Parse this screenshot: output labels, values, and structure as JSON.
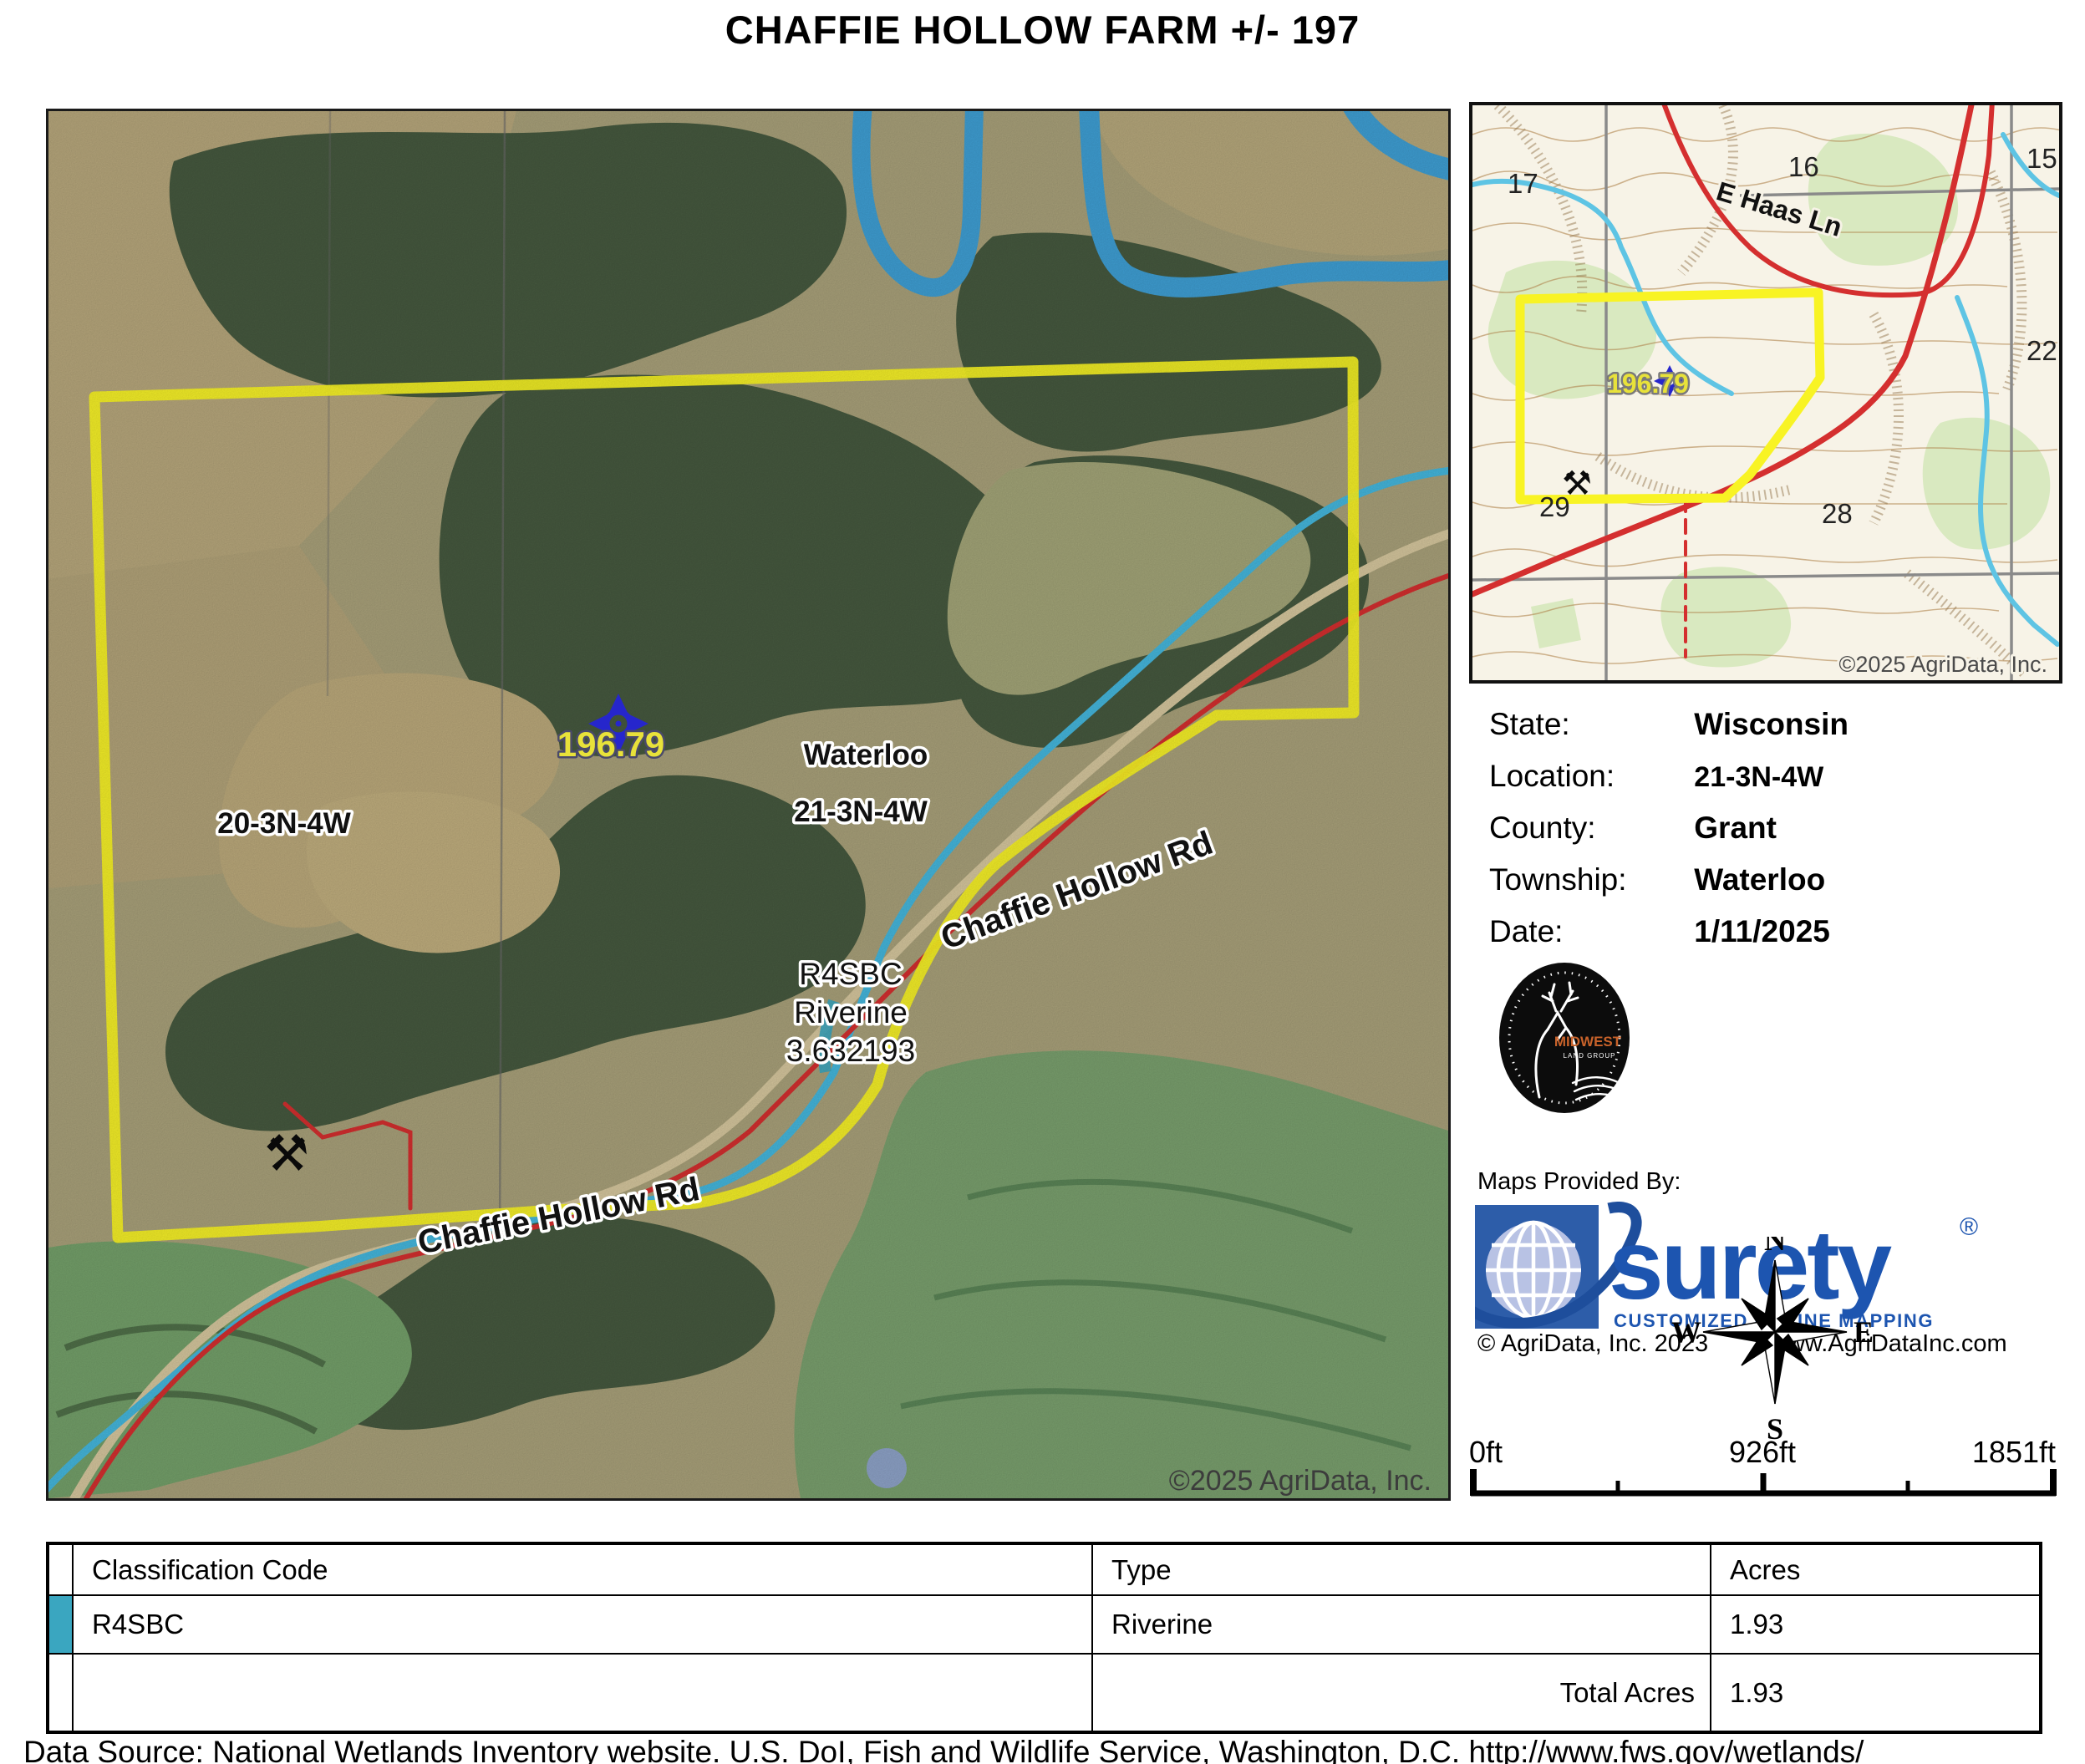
{
  "title": "CHAFFIE HOLLOW FARM +/- 197",
  "main_map": {
    "labels": {
      "marker_acreage": "196.79",
      "township": "Waterloo",
      "section": "21-3N-4W",
      "section_west": "20-3N-4W",
      "road_ne": "Chaffie Hollow Rd",
      "road_sw": "Chaffie Hollow Rd",
      "wetland_code": "R4SBC",
      "wetland_type": "Riverine",
      "wetland_acres": "3.632193",
      "copyright": "©2025 AgriData, Inc."
    }
  },
  "inset_map": {
    "sections": {
      "s17": "17",
      "s16": "16",
      "s15": "15",
      "s22": "22",
      "s29": "29",
      "s28": "28"
    },
    "road_label": "E Haas Ln",
    "marker_acreage": "196.79",
    "copyright": "©2025 AgriData, Inc."
  },
  "info_panel": {
    "rows": [
      {
        "label": "State:",
        "value": "Wisconsin"
      },
      {
        "label": "Location:",
        "value": "21-3N-4W"
      },
      {
        "label": "County:",
        "value": "Grant"
      },
      {
        "label": "Township:",
        "value": "Waterloo"
      },
      {
        "label": "Date:",
        "value": "1/11/2025"
      }
    ]
  },
  "branding": {
    "maps_provided_by": "Maps Provided By:",
    "midwest_logo_line1": "MIDWEST",
    "midwest_logo_line2": "LAND GROUP",
    "surety_name": "surety",
    "surety_reg": "®",
    "surety_tagline": "CUSTOMIZED ONLINE MAPPING",
    "agridata_copyright": "© AgriData, Inc. 2023",
    "agridata_url": "www.AgriDataInc.com"
  },
  "compass": {
    "n": "N",
    "s": "S",
    "e": "E",
    "w": "W"
  },
  "scale_bar": {
    "start": "0ft",
    "mid": "926ft",
    "end": "1851ft"
  },
  "wetlands_table": {
    "headers": [
      "Classification Code",
      "Type",
      "Acres"
    ],
    "rows": [
      {
        "code": "R4SBC",
        "type": "Riverine",
        "acres": "1.93",
        "swatch_color": "#3aa6c0"
      }
    ],
    "total_label": "Total Acres",
    "total_value": "1.93"
  },
  "data_source": "Data Source: National Wetlands Inventory website. U.S. DoI, Fish and Wildlife Service, Washington, D.C. http://www.fws.gov/wetlands/",
  "colors": {
    "parcel_boundary": "#f8f324",
    "wetland_swatch": "#3aa6c0",
    "surety_blue": "#1d55b0",
    "road_red": "#d42f2f",
    "stream_cyan": "#45b7dd",
    "river_blue": "#3f9fd4",
    "marker_blue": "#2626cc",
    "marker_text_yellow": "#e8e23a"
  }
}
